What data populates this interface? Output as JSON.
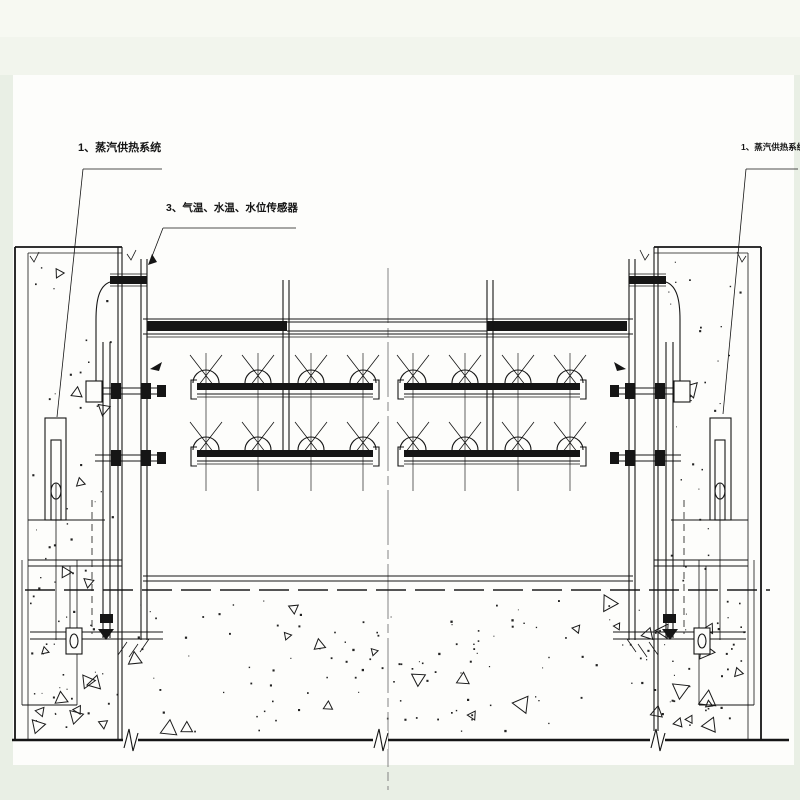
{
  "drawing": {
    "labels": {
      "steam_left": "1、蒸汽供热系统",
      "sensors": "3、气温、水温、水位传感器",
      "steam_right": "1、蒸汽供热系统"
    },
    "colors": {
      "line": "#151515",
      "paper": "#fdfdfb",
      "margin": "#e9efe5",
      "margin_top": "#f6f8f1",
      "centerline": "#777777"
    }
  }
}
